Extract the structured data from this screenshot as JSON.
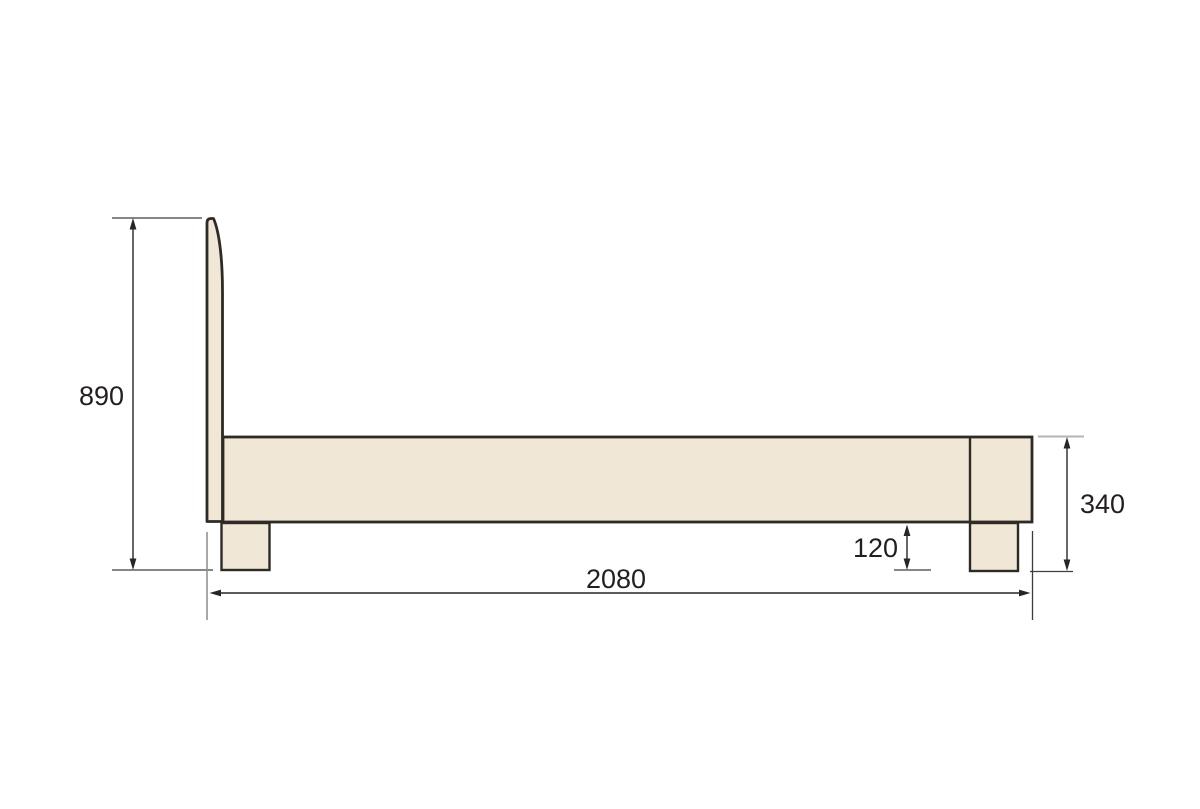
{
  "figure": {
    "type": "dimension-drawing",
    "subject": "bed-side-view"
  },
  "dimensions": {
    "overall_height": "890",
    "rail_height": "340",
    "floor_clearance": "120",
    "overall_length": "2080"
  },
  "colors": {
    "background": "#ffffff",
    "panel": "#f1e7d6",
    "outline": "#2e2a25",
    "dim": "#262626",
    "tick": "#3f3f3f",
    "tick_light": "#b4b4b4",
    "ext_light": "#929292",
    "ext_dark": "#3c3c3c",
    "text": "#231f20"
  }
}
